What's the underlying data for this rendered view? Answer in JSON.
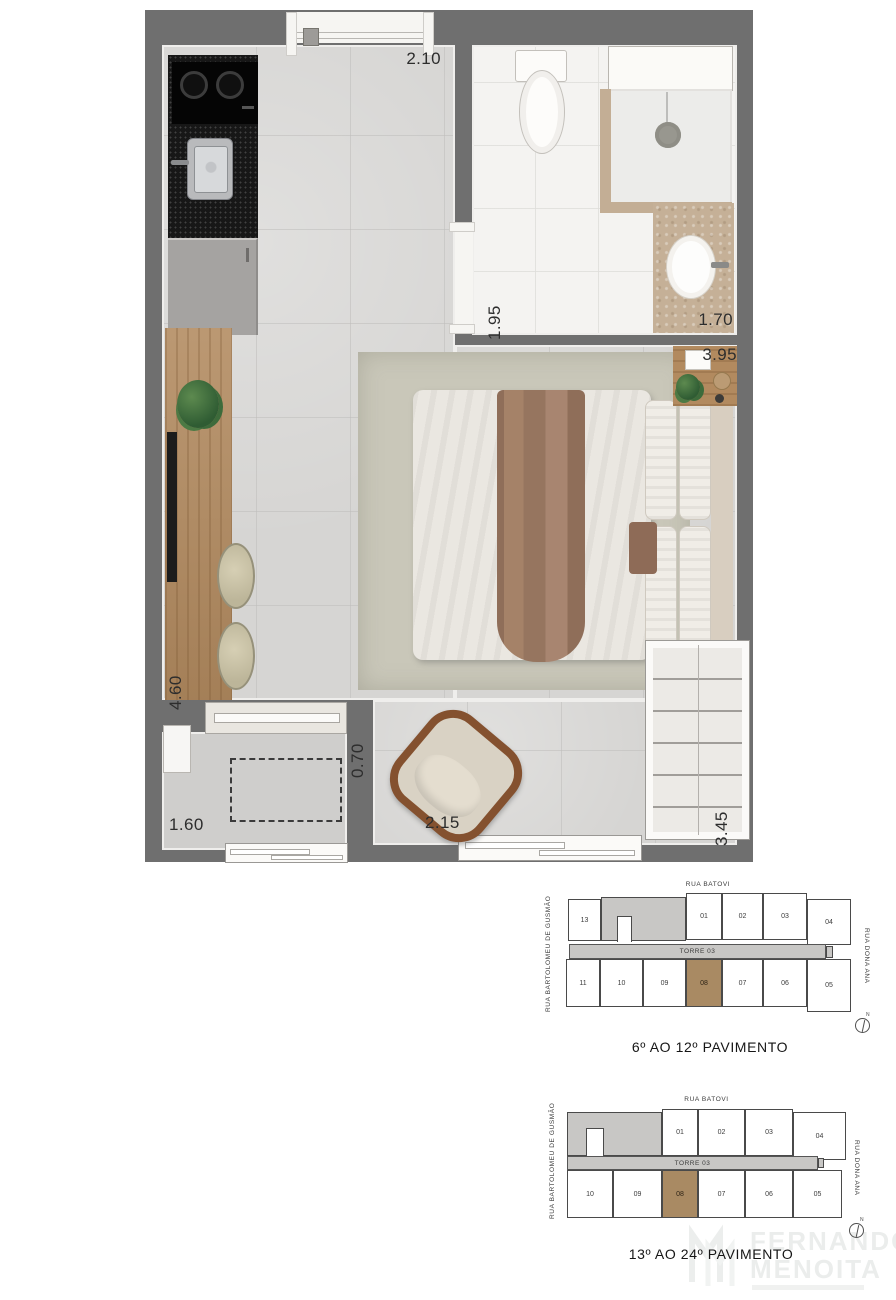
{
  "floorplan": {
    "dims": {
      "top_width": "2.10",
      "bath_depth": "1.95",
      "bath_width": "1.70",
      "bedroom_width": "3.95",
      "desk_length": "4.60",
      "balcony_width": "1.60",
      "balcony_depth": "0.70",
      "window_width": "2.15",
      "wardrobe_length": "3.45"
    }
  },
  "keyplans": [
    {
      "street_top": "RUA BATOVI",
      "street_left": "RUA BARTOLOMEU DE GUSMÃO",
      "street_right": "RUA DONA ANA",
      "tower": "TORRE 03",
      "top_units": [
        "13",
        "01",
        "02",
        "03",
        "04"
      ],
      "bottom_units": [
        "11",
        "10",
        "09",
        "08",
        "07",
        "06",
        "05"
      ],
      "highlighted_unit": "08",
      "caption": "6º AO 12º PAVIMENTO",
      "compass": "N"
    },
    {
      "street_top": "RUA BATOVI",
      "street_left": "RUA BARTOLOMEU DE GUSMÃO",
      "street_right": "RUA DONA ANA",
      "tower": "TORRE 03",
      "top_units": [
        "01",
        "02",
        "03",
        "04"
      ],
      "bottom_units": [
        "10",
        "09",
        "08",
        "07",
        "06",
        "05"
      ],
      "highlighted_unit": "08",
      "caption": "13º AO 24º PAVIMENTO",
      "compass": "N"
    }
  ],
  "watermark": {
    "line1": "FERNANDO",
    "line2": "MENOITA"
  },
  "colors": {
    "wall": "#6f6f6f",
    "floor": "#d6d5d3",
    "bath_floor": "#f4f3f1",
    "unit_highlight": "#a98a63",
    "keyplan_gray": "#c8c7c5",
    "wood": "#b28a5f"
  }
}
